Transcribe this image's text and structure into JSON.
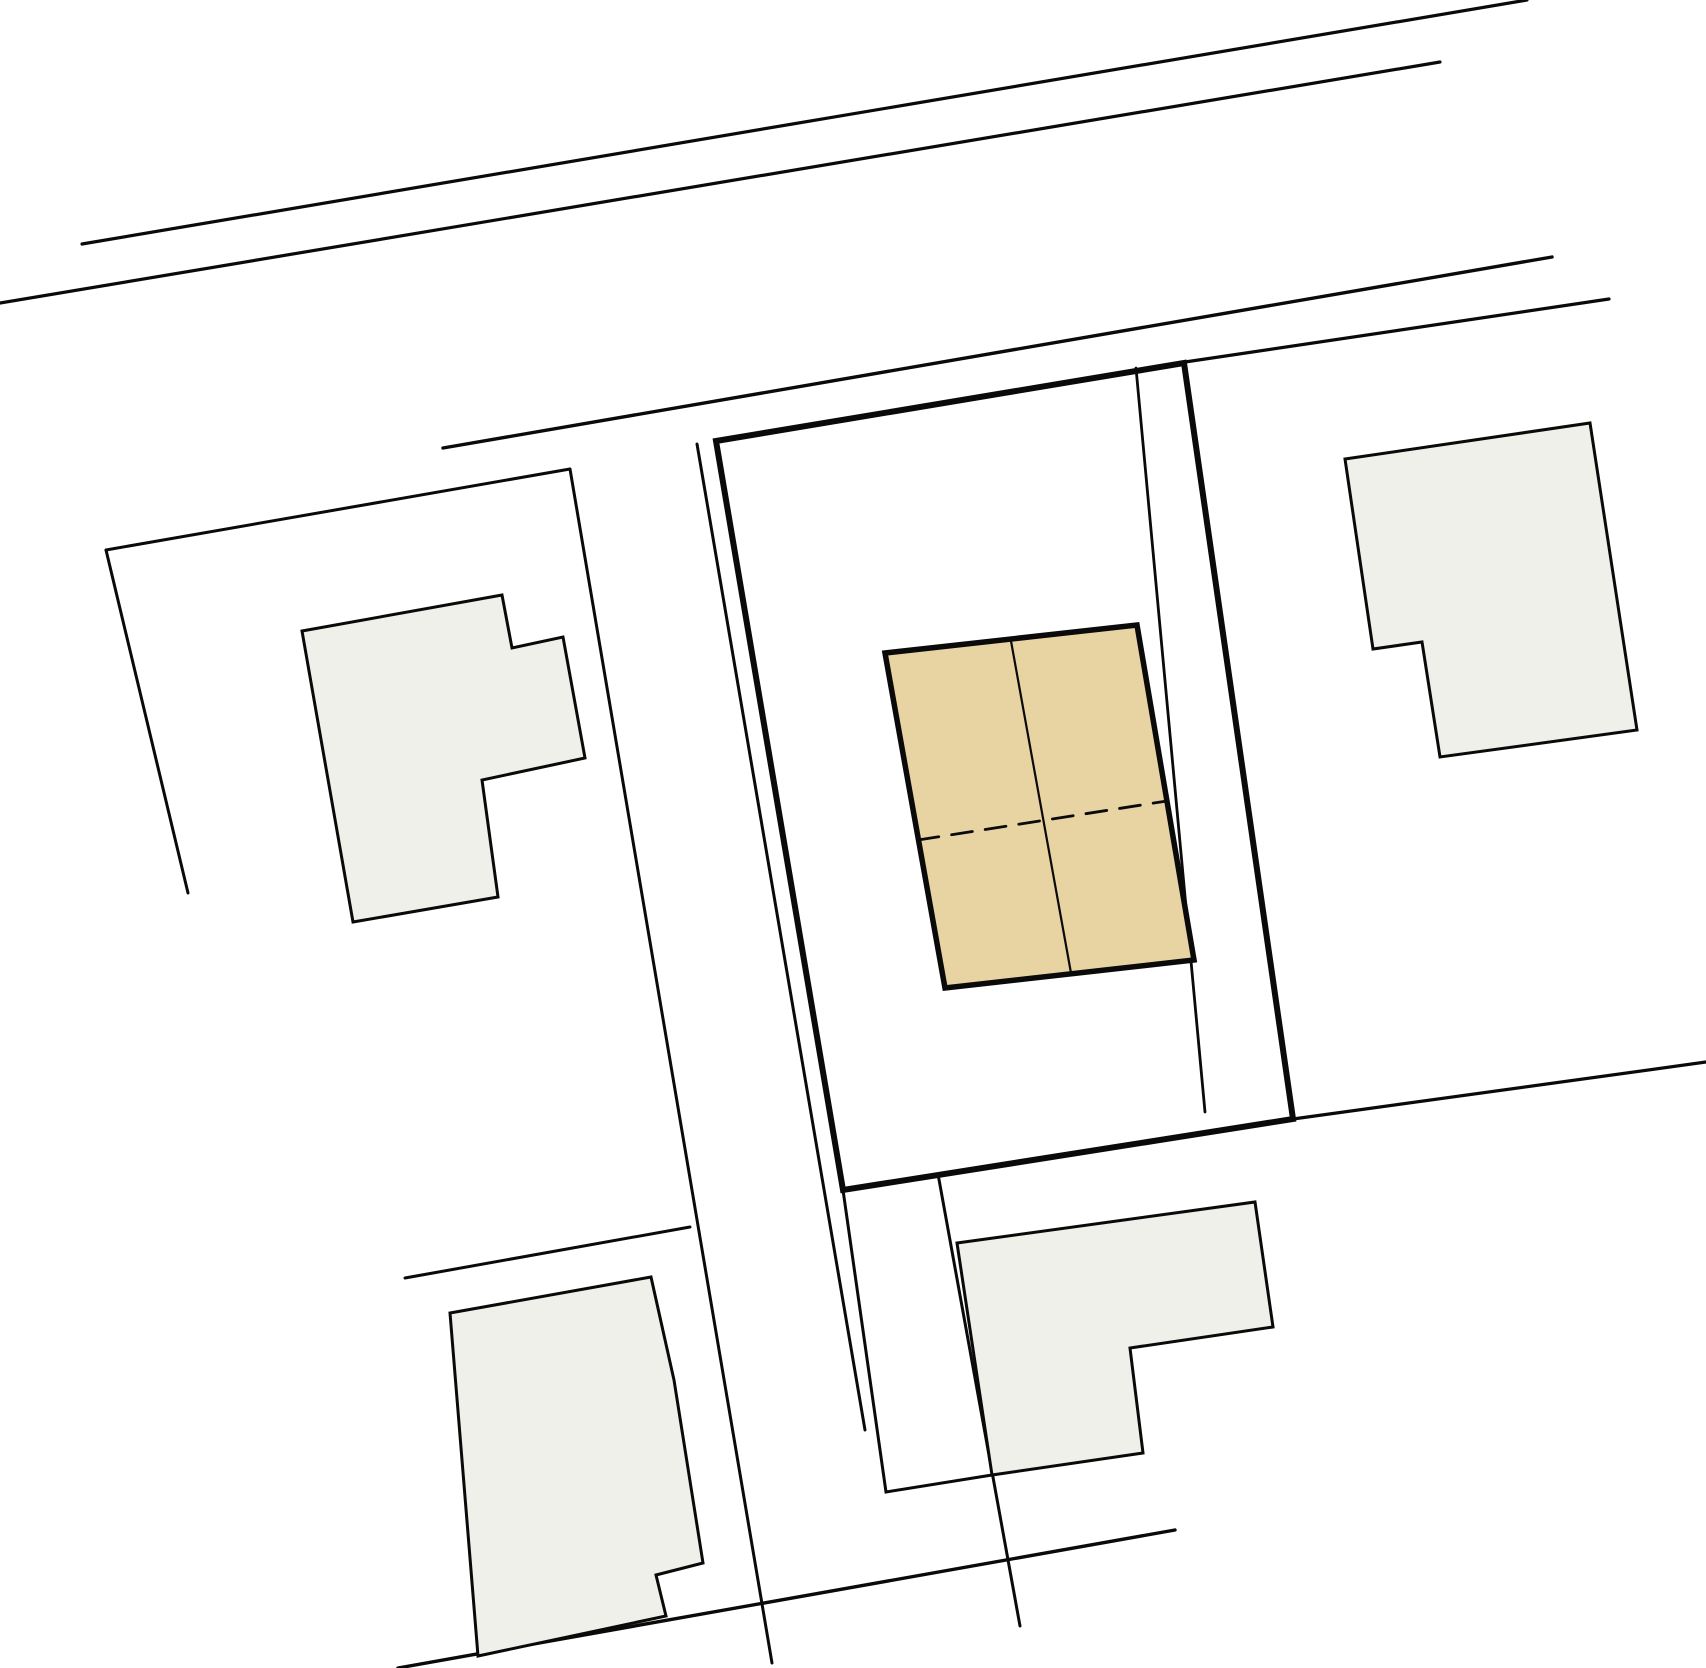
{
  "canvas": {
    "width": 1706,
    "height": 1668,
    "background": "#ffffff"
  },
  "palette": {
    "line": "#0a0a0a",
    "neighbor_building_fill": "#f0f0ea",
    "subject_building_fill": "#e8d3a2"
  },
  "plan": {
    "shapes": [
      {
        "name": "road-line-upper",
        "kind": "line",
        "closed": false,
        "stroke_width": 3.2,
        "points": [
          [
            82,
            244
          ],
          [
            1527,
            0
          ]
        ]
      },
      {
        "name": "road-line-lower",
        "kind": "line",
        "closed": false,
        "stroke_width": 3.2,
        "points": [
          [
            0,
            303
          ],
          [
            1440,
            62
          ]
        ]
      },
      {
        "name": "street-edge-north",
        "kind": "line",
        "closed": false,
        "stroke_width": 3.4,
        "points": [
          [
            443,
            448
          ],
          [
            1552,
            257
          ]
        ]
      },
      {
        "name": "street-edge-east",
        "kind": "line",
        "closed": false,
        "stroke_width": 3.2,
        "points": [
          [
            1185,
            362
          ],
          [
            1609,
            299
          ]
        ]
      },
      {
        "name": "boundary-southeast",
        "kind": "line",
        "closed": false,
        "stroke_width": 3.2,
        "points": [
          [
            1293,
            1119
          ],
          [
            1706,
            1062
          ]
        ]
      },
      {
        "name": "road-diagonal-south",
        "kind": "line",
        "closed": false,
        "stroke_width": 3.4,
        "points": [
          [
            398,
            1668
          ],
          [
            1175,
            1530
          ]
        ]
      },
      {
        "name": "left-parcel-north-boundary",
        "kind": "line",
        "closed": false,
        "stroke_width": 3.0,
        "points": [
          [
            106,
            550
          ],
          [
            570,
            469
          ]
        ]
      },
      {
        "name": "left-parcel-west-boundary",
        "kind": "line",
        "closed": false,
        "stroke_width": 3.0,
        "points": [
          [
            106,
            550
          ],
          [
            188,
            893
          ]
        ]
      },
      {
        "name": "boundary-vertical-west",
        "kind": "line",
        "closed": false,
        "stroke_width": 3.0,
        "points": [
          [
            570,
            469
          ],
          [
            772,
            1663
          ]
        ]
      },
      {
        "name": "boundary-vertical-driveway",
        "kind": "line",
        "closed": false,
        "stroke_width": 3.0,
        "points": [
          [
            697,
            444
          ],
          [
            865,
            1430
          ]
        ]
      },
      {
        "name": "boundary-below-parcel",
        "kind": "polyline",
        "closed": false,
        "stroke_width": 3.0,
        "points": [
          [
            843,
            1190
          ],
          [
            886,
            1492
          ],
          [
            992,
            1475
          ]
        ]
      },
      {
        "name": "boundary-vertical-south",
        "kind": "line",
        "closed": false,
        "stroke_width": 3.0,
        "points": [
          [
            938,
            1174
          ],
          [
            1020,
            1626
          ]
        ]
      },
      {
        "name": "boundary-inner-east",
        "kind": "line",
        "closed": false,
        "stroke_width": 2.8,
        "points": [
          [
            1136,
            368
          ],
          [
            1205,
            1112
          ]
        ]
      },
      {
        "name": "bottomleft-parcel-north-boundary",
        "kind": "line",
        "closed": false,
        "stroke_width": 3.0,
        "points": [
          [
            405,
            1278
          ],
          [
            690,
            1227
          ]
        ]
      },
      {
        "name": "subject-parcel-outline",
        "kind": "polygon",
        "closed": true,
        "stroke_width": 6.0,
        "points": [
          [
            716,
            441
          ],
          [
            1184,
            363
          ],
          [
            1293,
            1119
          ],
          [
            843,
            1190
          ]
        ]
      },
      {
        "name": "building-northwest",
        "kind": "polygon",
        "closed": true,
        "stroke_width": 3.0,
        "fill": "neighbor_building_fill",
        "points": [
          [
            302,
            631
          ],
          [
            502,
            595
          ],
          [
            512,
            648
          ],
          [
            563,
            637
          ],
          [
            585,
            758
          ],
          [
            482,
            780
          ],
          [
            498,
            897
          ],
          [
            353,
            922
          ]
        ]
      },
      {
        "name": "building-northeast",
        "kind": "polygon",
        "closed": true,
        "stroke_width": 3.0,
        "fill": "neighbor_building_fill",
        "points": [
          [
            1345,
            459
          ],
          [
            1590,
            423
          ],
          [
            1637,
            730
          ],
          [
            1440,
            757
          ],
          [
            1422,
            642
          ],
          [
            1373,
            649
          ]
        ]
      },
      {
        "name": "building-south",
        "kind": "polygon",
        "closed": true,
        "stroke_width": 3.0,
        "fill": "neighbor_building_fill",
        "points": [
          [
            957,
            1243
          ],
          [
            1255,
            1202
          ],
          [
            1273,
            1327
          ],
          [
            1130,
            1348
          ],
          [
            1143,
            1453
          ],
          [
            992,
            1475
          ]
        ]
      },
      {
        "name": "building-southwest",
        "kind": "polygon",
        "closed": true,
        "stroke_width": 3.0,
        "fill": "neighbor_building_fill",
        "points": [
          [
            450,
            1313
          ],
          [
            651,
            1277
          ],
          [
            674,
            1380
          ],
          [
            703,
            1563
          ],
          [
            656,
            1575
          ],
          [
            666,
            1616
          ],
          [
            478,
            1656
          ]
        ]
      },
      {
        "name": "subject-building",
        "kind": "polygon",
        "closed": true,
        "stroke_width": 5.5,
        "fill": "subject_building_fill",
        "points": [
          [
            885,
            653
          ],
          [
            1137,
            625
          ],
          [
            1194,
            960
          ],
          [
            945,
            988
          ]
        ]
      },
      {
        "name": "subject-building-divider",
        "kind": "line",
        "closed": false,
        "stroke_width": 2.2,
        "points": [
          [
            1011,
            641
          ],
          [
            1071,
            973
          ]
        ]
      },
      {
        "name": "subject-building-ridge-dashed",
        "kind": "line",
        "closed": false,
        "stroke_width": 2.8,
        "dash": "21,13",
        "points": [
          [
            918,
            840
          ],
          [
            1167,
            801
          ]
        ]
      }
    ]
  }
}
